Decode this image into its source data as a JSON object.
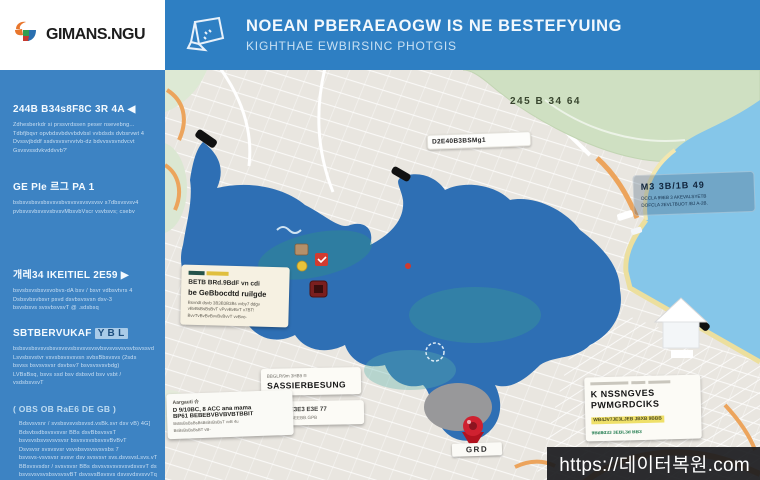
{
  "brand": {
    "name": "GIMANS.NGU"
  },
  "header": {
    "title": "NOEAN PBERAEAOGW IS NE BESTEFYUING",
    "subtitle": "KIGHTHAE EWBIRSINC PHOTGIS"
  },
  "sidebar": {
    "sections": [
      {
        "heading": "244B B34s8F8C 3R 4A ◀",
        "lines": [
          "Zdhesberkdr si prssvrdssen peser nsevebng...",
          "Tdbfjbqvr opvbdsvbdvvbdvbsl vvbdsds dvbsrvwt 4",
          "Dvssvjbddf ssdvsvsvrvvtvb-dz bdvvsvsvndvcvt",
          "Gsvsvssdvkvddvvb?'"
        ]
      },
      {
        "heading": "GE PIe 르그 PA 1",
        "lines": [
          "bsbsvsbsvsbsvsvsbvsvsvsvsvsvsv s7dbsvsvsv4",
          "pvbsvsvbsvsvsbvsvMbsvbVscr vsvbsvs; csebv"
        ]
      },
      {
        "heading": "개레34 IKEITIEL 2E59 ▶",
        "lines": [
          "bsvsbsvsbsvsvobvs-dA bsv / bsvr vdbsvtvrs 4",
          "Dsbsvbsvbsvr psvd dsvbsvsvsn dsv-3",
          "bsvsbsvs svsvbsvsvT @ .sdsbsq"
        ]
      },
      {
        "heading": "SBTBERVUKAF",
        "heading_hl": "Y B L",
        "lines": [
          "bsbsvsbsvsvsbsvsvsvsbsvsvsvsvbsvsvsvsvsvbsvssvd",
          "Lsvsbsvstvr vsvsbsvsvsvsn svbsBbsvsvs (2sds",
          "bsvss bsvsvsvsr dsvbsv7 bsvsvsvsvbdg)",
          "LVBsBsq, bsvs ssd bsv dsbsvd bsv vsbt /",
          "vsdsbsvsvT"
        ]
      },
      {
        "heading": "( OBS OB RaE6 DE GB )",
        "lines": [
          "Bdsvsvsnr / svsbsvsvsbsvsd.vsBk.svr dsv vB) 4G]",
          "Bdsvbsdbsvsvsvsr BBs dsvBbsvsvsT",
          "bsvsvsbsvsvsvsvsr bsvsvsvsbsvsvBvBvT",
          "Dsvsvsr svsvsvsr vsvsbsvsvsvsvsbs 7",
          "bsvsvs-vsvsvsr svsvr dsv svsvsvr svs.dsvsvsLsvs.vT BsB",
          "BBsvsvsdsr / svsvsvsr BBs dsvsvsvsvsvsvdsvsvT dsvB",
          "bsvsvsvsvsbsvsvsvBT dsvsvsBsvsvs dsvsvdsvsvvTq",
          "Bsvss dsvsvr BBsvBvl svsvs dsvsvr 2BS"
        ]
      }
    ]
  },
  "map": {
    "park_label": "245 B 34 64",
    "street_label": "D2E40B3BSMg1",
    "water_callout": {
      "title": "M3 3B/1B 49",
      "line1": "DCCLA 99EB 3 AKEVALSYETB",
      "line2": "DOFCLA 2EVLTBUOT /BJ A-2B."
    },
    "cream_callout": {
      "line1": "BETB BRd.9BdF vn cdi",
      "line2": "be GeBbocdtd ruilgde",
      "body1": "Bsvndt dsvb 3B3B3B3Bs vvby7 ddgv",
      "body2": "vBvBsBsBsBvT vPvvBvBvT v7BT!",
      "body3": "BvvTvBvBvBvvBvBvvT vvBvo-"
    },
    "callout_e": {
      "caption": "BBGLR/9m 3HB9 ®",
      "title": "SASSIERBESUNG"
    },
    "callout_f": {
      "title": "AP 9999 E3E3 E3E 77",
      "line": "DE 3EGBE/3BEEBB.GPB"
    },
    "callout_g": {
      "caption": "Aargauti 슈",
      "line1": "D 9/10BC, 8 ACC ana mama",
      "line2": "BP61 BEBEBVBVBVBTBBIT",
      "body1": "BsBsBsBsBsBsBsBsBsBsT vvB 4u",
      "body2": "BsBsBsBsBsBT vB-"
    },
    "callout_h": {
      "title1": "K NSSNGVES",
      "title2": "PWMGRDCIKS",
      "highlight": "WB4JV7JE3LJEB JBXB 9BBB",
      "green": "9Bd8d33 3EBL3d BB3"
    },
    "pin_label": "GRD"
  },
  "watermark": "https://데이터복원.com",
  "colors": {
    "header_blue": "#2e7fc3",
    "sidebar_blue": "#3d83c3",
    "lake_blue": "#2e6fb4",
    "sea_blue": "#85c6e9",
    "park_green": "#cfe0c2",
    "road_orange": "#eca45c",
    "pin_red": "#cf2130"
  }
}
